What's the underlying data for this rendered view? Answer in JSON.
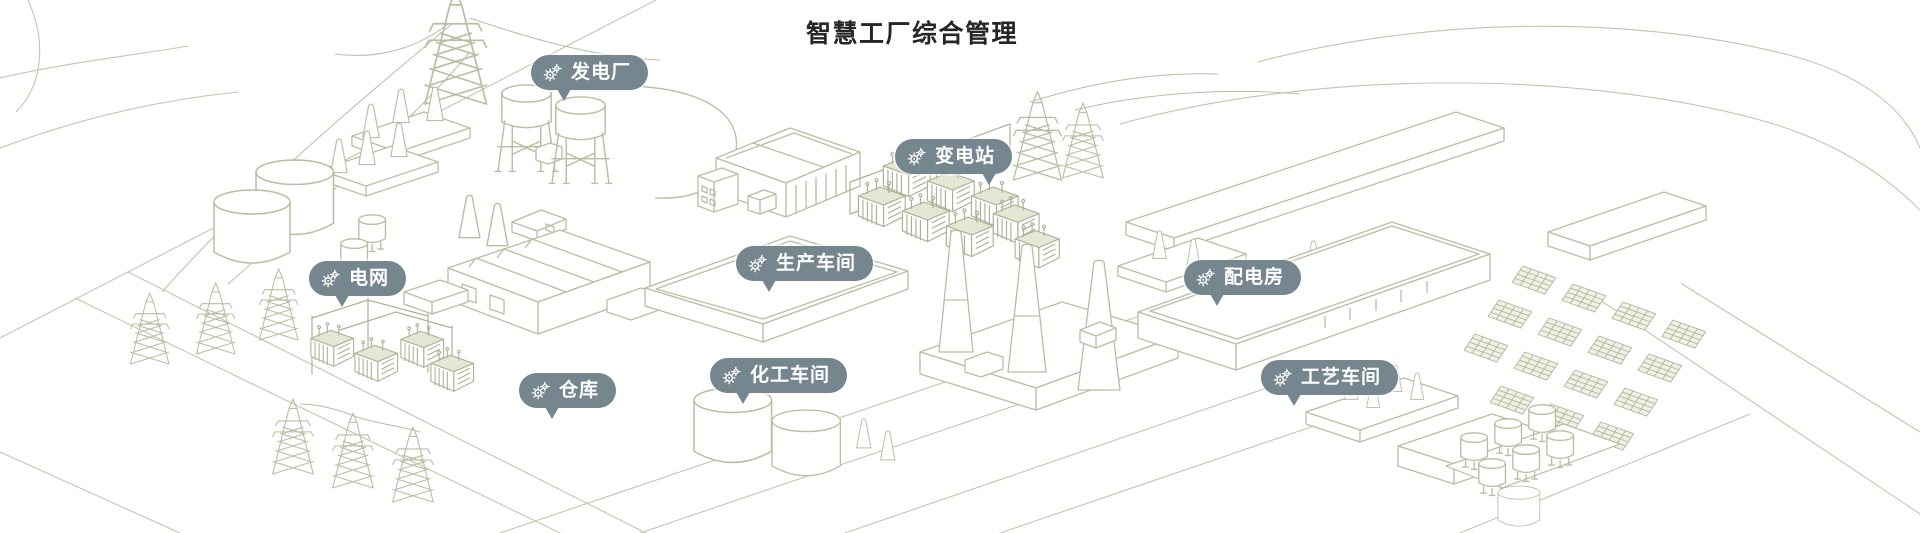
{
  "title": "智慧工厂综合管理",
  "colors": {
    "pin_background": "#76868f",
    "pin_text": "#ffffff",
    "line_art": "#b6bfa3",
    "title_text": "#262626",
    "canvas_background": "#ffffff"
  },
  "pins": [
    {
      "id": "power-plant",
      "label": "发电厂",
      "icon": "gears-icon"
    },
    {
      "id": "substation",
      "label": "变电站",
      "icon": "gears-icon"
    },
    {
      "id": "power-grid",
      "label": "电网",
      "icon": "gears-icon"
    },
    {
      "id": "production-workshop",
      "label": "生产车间",
      "icon": "gears-icon"
    },
    {
      "id": "distribution-room",
      "label": "配电房",
      "icon": "gears-icon"
    },
    {
      "id": "warehouse",
      "label": "仓库",
      "icon": "gears-icon"
    },
    {
      "id": "chemical-workshop",
      "label": "化工车间",
      "icon": "gears-icon"
    },
    {
      "id": "process-workshop",
      "label": "工艺车间",
      "icon": "gears-icon"
    }
  ]
}
